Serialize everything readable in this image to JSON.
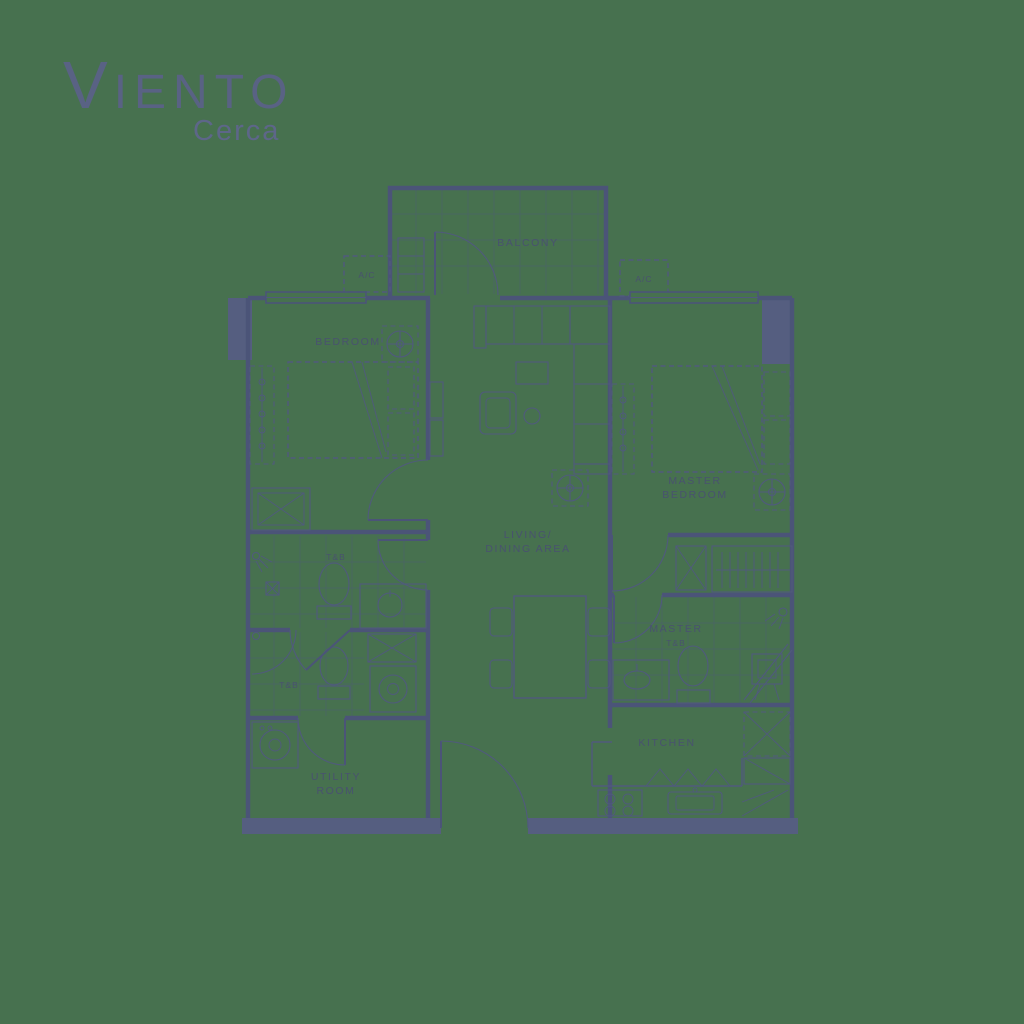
{
  "brand": {
    "initial": "V",
    "rest": "IENTO",
    "tagline": "Cerca"
  },
  "floor_plan": {
    "rooms": {
      "balcony": "BALCONY",
      "bedroom": "BEDROOM",
      "living_line1": "LIVING/",
      "living_line2": "DINING AREA",
      "master_line1": "MASTER",
      "master_line2": "BEDROOM",
      "toilet_bath": "T&B",
      "master_bath_line1": "MASTER",
      "master_bath_line2": "T&B",
      "utility_line1": "UTILITY",
      "utility_line2": "ROOM",
      "kitchen": "KITCHEN",
      "ac_unit": "A/C"
    },
    "colors": {
      "background": "#47714F",
      "line": "#4B5478",
      "wall_fill": "#555E80",
      "text": "#49526F"
    }
  }
}
